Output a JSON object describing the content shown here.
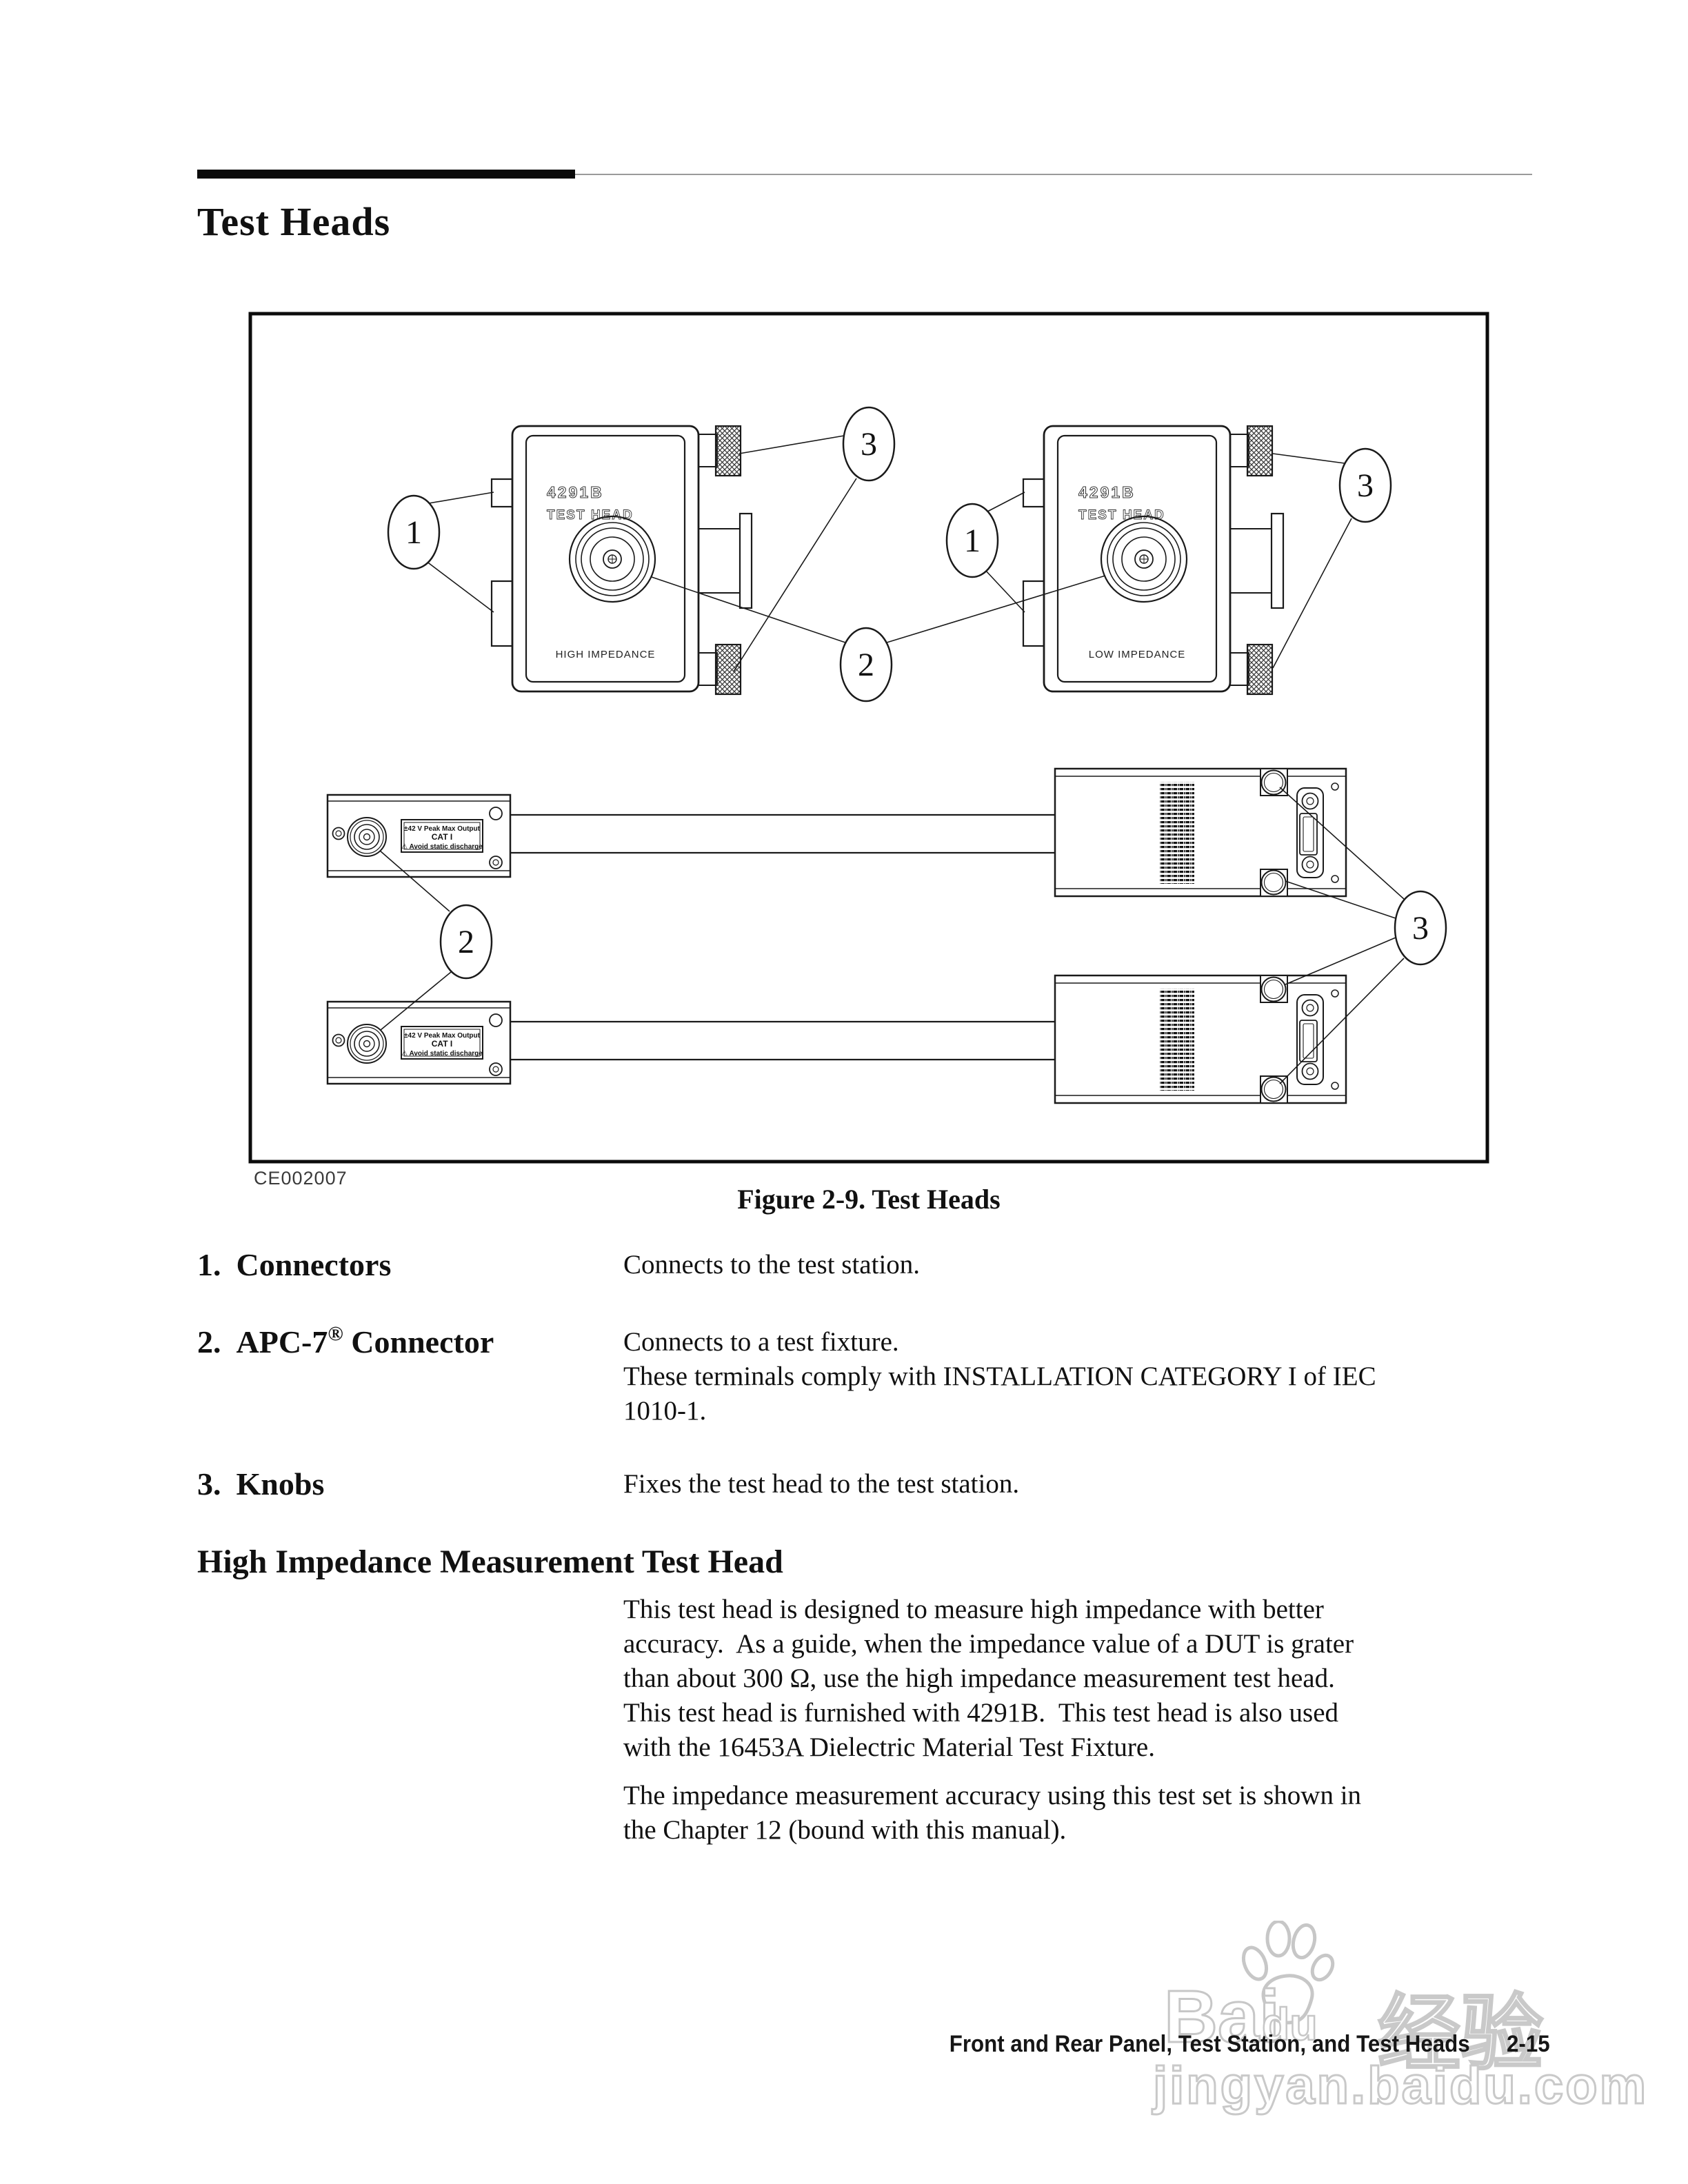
{
  "page": {
    "heading": "Test Heads"
  },
  "figure": {
    "credit": "CE002007",
    "caption": "Figure 2-9. Test Heads",
    "callout_labels": {
      "connectors": "1",
      "apc7": "2",
      "knobs": "3"
    },
    "test_heads": [
      {
        "model": "4291B",
        "type": "TEST HEAD",
        "impedance": "HIGH IMPEDANCE"
      },
      {
        "model": "4291B",
        "type": "TEST HEAD",
        "impedance": "LOW IMPEDANCE"
      }
    ],
    "warning_label": {
      "line1": "±42 V Peak Max Output",
      "line2": "CAT I",
      "line3": "⚠ Avoid static discharge"
    }
  },
  "items": [
    {
      "number": "1.",
      "name": "Connectors",
      "reg": "",
      "name2": "",
      "description": [
        "Connects to the test station."
      ]
    },
    {
      "number": "2.",
      "name": "APC-7",
      "reg": "®",
      "name2": " Connector",
      "description": [
        "Connects to a test fixture.",
        "These terminals comply with INSTALLATION CATEGORY I of IEC",
        "1010-1."
      ]
    },
    {
      "number": "3.",
      "name": "Knobs",
      "reg": "",
      "name2": "",
      "description": [
        "Fixes the test head to the test station."
      ]
    }
  ],
  "section": {
    "heading": "High Impedance Measurement Test Head",
    "para1": [
      "This test head is designed to measure high impedance with better",
      "accuracy.  As a guide, when the impedance value of a DUT is grater",
      "than about 300 Ω, use the high impedance measurement test head.",
      "This test head is furnished with 4291B.  This test head is also used",
      "with the 16453A Dielectric Material Test Fixture."
    ],
    "para2": [
      "The impedance measurement accuracy using this test set is shown in",
      "the Chapter 12 (bound with this manual)."
    ]
  },
  "footer": {
    "chapter": "Front and Rear Panel, Test Station, and Test Heads",
    "page_number": "2-15"
  },
  "watermark": {
    "brand_a": "Bai",
    "brand_b": "du",
    "brand_cn": "经验",
    "url": "jingyan.baidu.com",
    "color": "#c7c7c7"
  }
}
